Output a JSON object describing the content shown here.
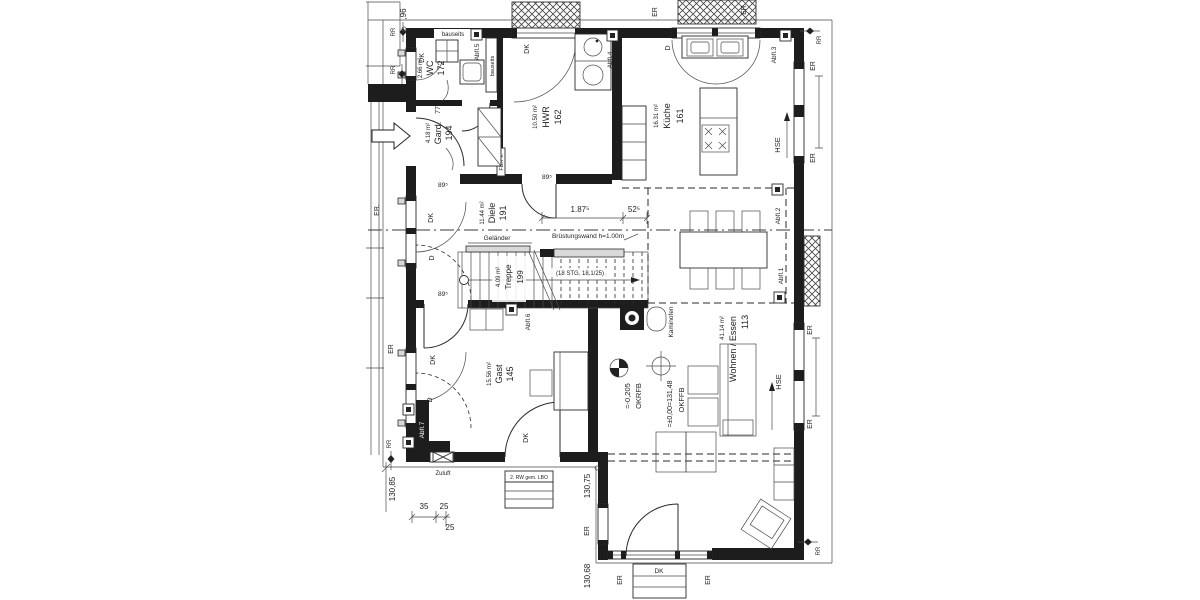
{
  "rooms": {
    "wc": {
      "number": "172",
      "name": "WC",
      "area": "2.66 m²"
    },
    "hwr": {
      "number": "162",
      "name": "HWR",
      "area": "10.50 m²"
    },
    "kueche": {
      "number": "161",
      "name": "Küche",
      "area": "16.31 m²"
    },
    "gard": {
      "number": "194",
      "name": "Gard.",
      "area": "4.18 m²"
    },
    "diele": {
      "number": "191",
      "name": "Diele",
      "area": "11.44 m²"
    },
    "treppe": {
      "number": "199",
      "name": "Treppe",
      "area": "4.09 m²"
    },
    "wohnen": {
      "number": "113",
      "name": "Wohnen / Essen",
      "area": "41.14 m²"
    },
    "gast": {
      "number": "145",
      "name": "Gast",
      "area": "15.56 m²"
    }
  },
  "labels": {
    "dk": "DK",
    "d": "D",
    "er": "ER",
    "er_dot": "ER.",
    "rr": "RR",
    "hse": "HSE"
  },
  "drains": {
    "a1": "Abfl.1",
    "a2": "Abfl.2",
    "a3": "Abfl.3",
    "a4": "Abfl.4",
    "a5": "Abfl.5",
    "a6": "Abfl.6",
    "a7": "Abfl.7"
  },
  "annotations": {
    "bauseits": "bauseits",
    "gelaender": "Geländer",
    "bruestungswand": "Brüstungswand h=1.00m",
    "stufen": "(18 STG. 18,1/25)",
    "kaminofen": "Kaminofen",
    "fbh": "FBH V.",
    "zuluft": "Zuluft",
    "rettungsweg": "2. RW gem. LBO",
    "okffb_label": "OKFFB",
    "okffb_value": "=±0,00=131,48",
    "okrfb_label": "OKRFB",
    "okrfb_value": "=-0,205"
  },
  "dimensions": {
    "d96": ",96",
    "d77": "77",
    "d895": "89⁵",
    "d1875": "1.87⁵",
    "d525": "52⁵",
    "d35": "35",
    "d25": "25",
    "d13085": "130,85",
    "d13075": "130,75",
    "d13068": "130,68"
  },
  "colors": {
    "wall": "#1d1d1d",
    "line": "#2a2a2a",
    "paper": "#ffffff",
    "window_gray": "#d9d9d9"
  }
}
